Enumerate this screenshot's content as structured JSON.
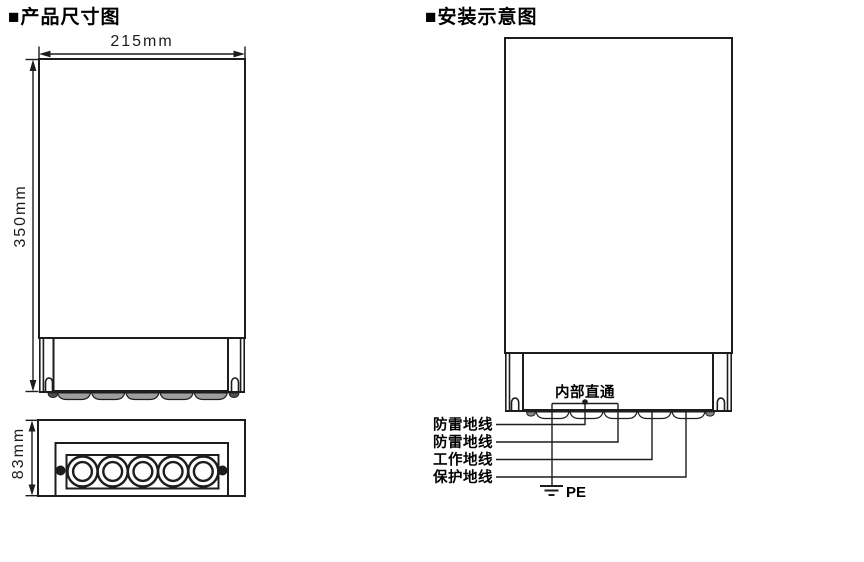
{
  "page": {
    "background": "#ffffff",
    "ink_color": "#1d1d1d",
    "scallop_gray": "#9e9e9e"
  },
  "left_diagram": {
    "title": "■产品尺寸图",
    "width_dimension": "215mm",
    "height_dimension": "350mm",
    "bottom_view_height_dimension": "83mm",
    "gland_count": 5
  },
  "right_diagram": {
    "title": "■安装示意图",
    "internal_link_label": "内部直通",
    "wire_labels": [
      "防雷地线",
      "防雷地线",
      "工作地线",
      "保护地线"
    ],
    "pe_label": "PE"
  }
}
